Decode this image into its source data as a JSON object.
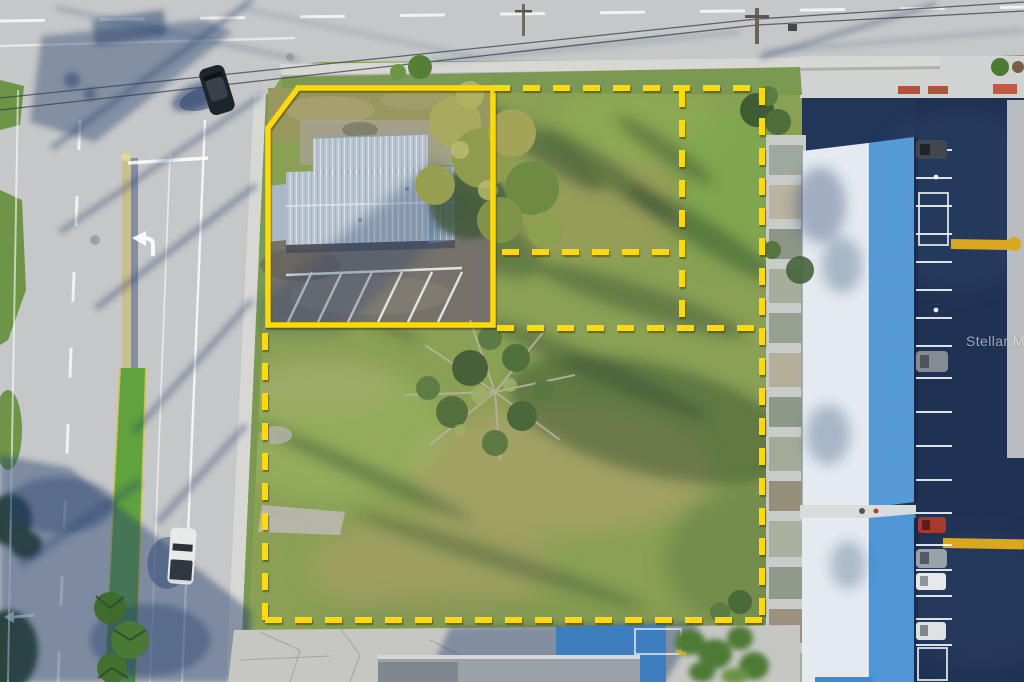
{
  "image": {
    "type": "aerial-real-estate-photo",
    "alt": "Drone aerial view of vacant land parcels outlined in yellow beside a divided road intersection, with a metal-roof commercial building in the solid-outlined parcel and a blue-roof motel building with parking lot on the right",
    "width": 1024,
    "height": 682
  },
  "watermark": {
    "text": "Stellar MLS"
  },
  "colors": {
    "boundary_yellow": "#ffd908",
    "road_gray": "#c6c7c8",
    "sidewalk_gray": "#d7d8d4",
    "verge_green": "#7b9950",
    "grass_base": "#8aa055",
    "median_green": "#61a13e",
    "asphalt_navy": "#223659",
    "roof_white": "#e4eaef",
    "roof_blue": "#569bd8",
    "metal_roof": "#b7c3cf",
    "parcel_asphalt": "#76726b",
    "court_blue": "#3e7dbe",
    "concrete": "#c6c7c3",
    "paint_yellow": "#d9a81f",
    "shadow_blue": "#26406e"
  }
}
